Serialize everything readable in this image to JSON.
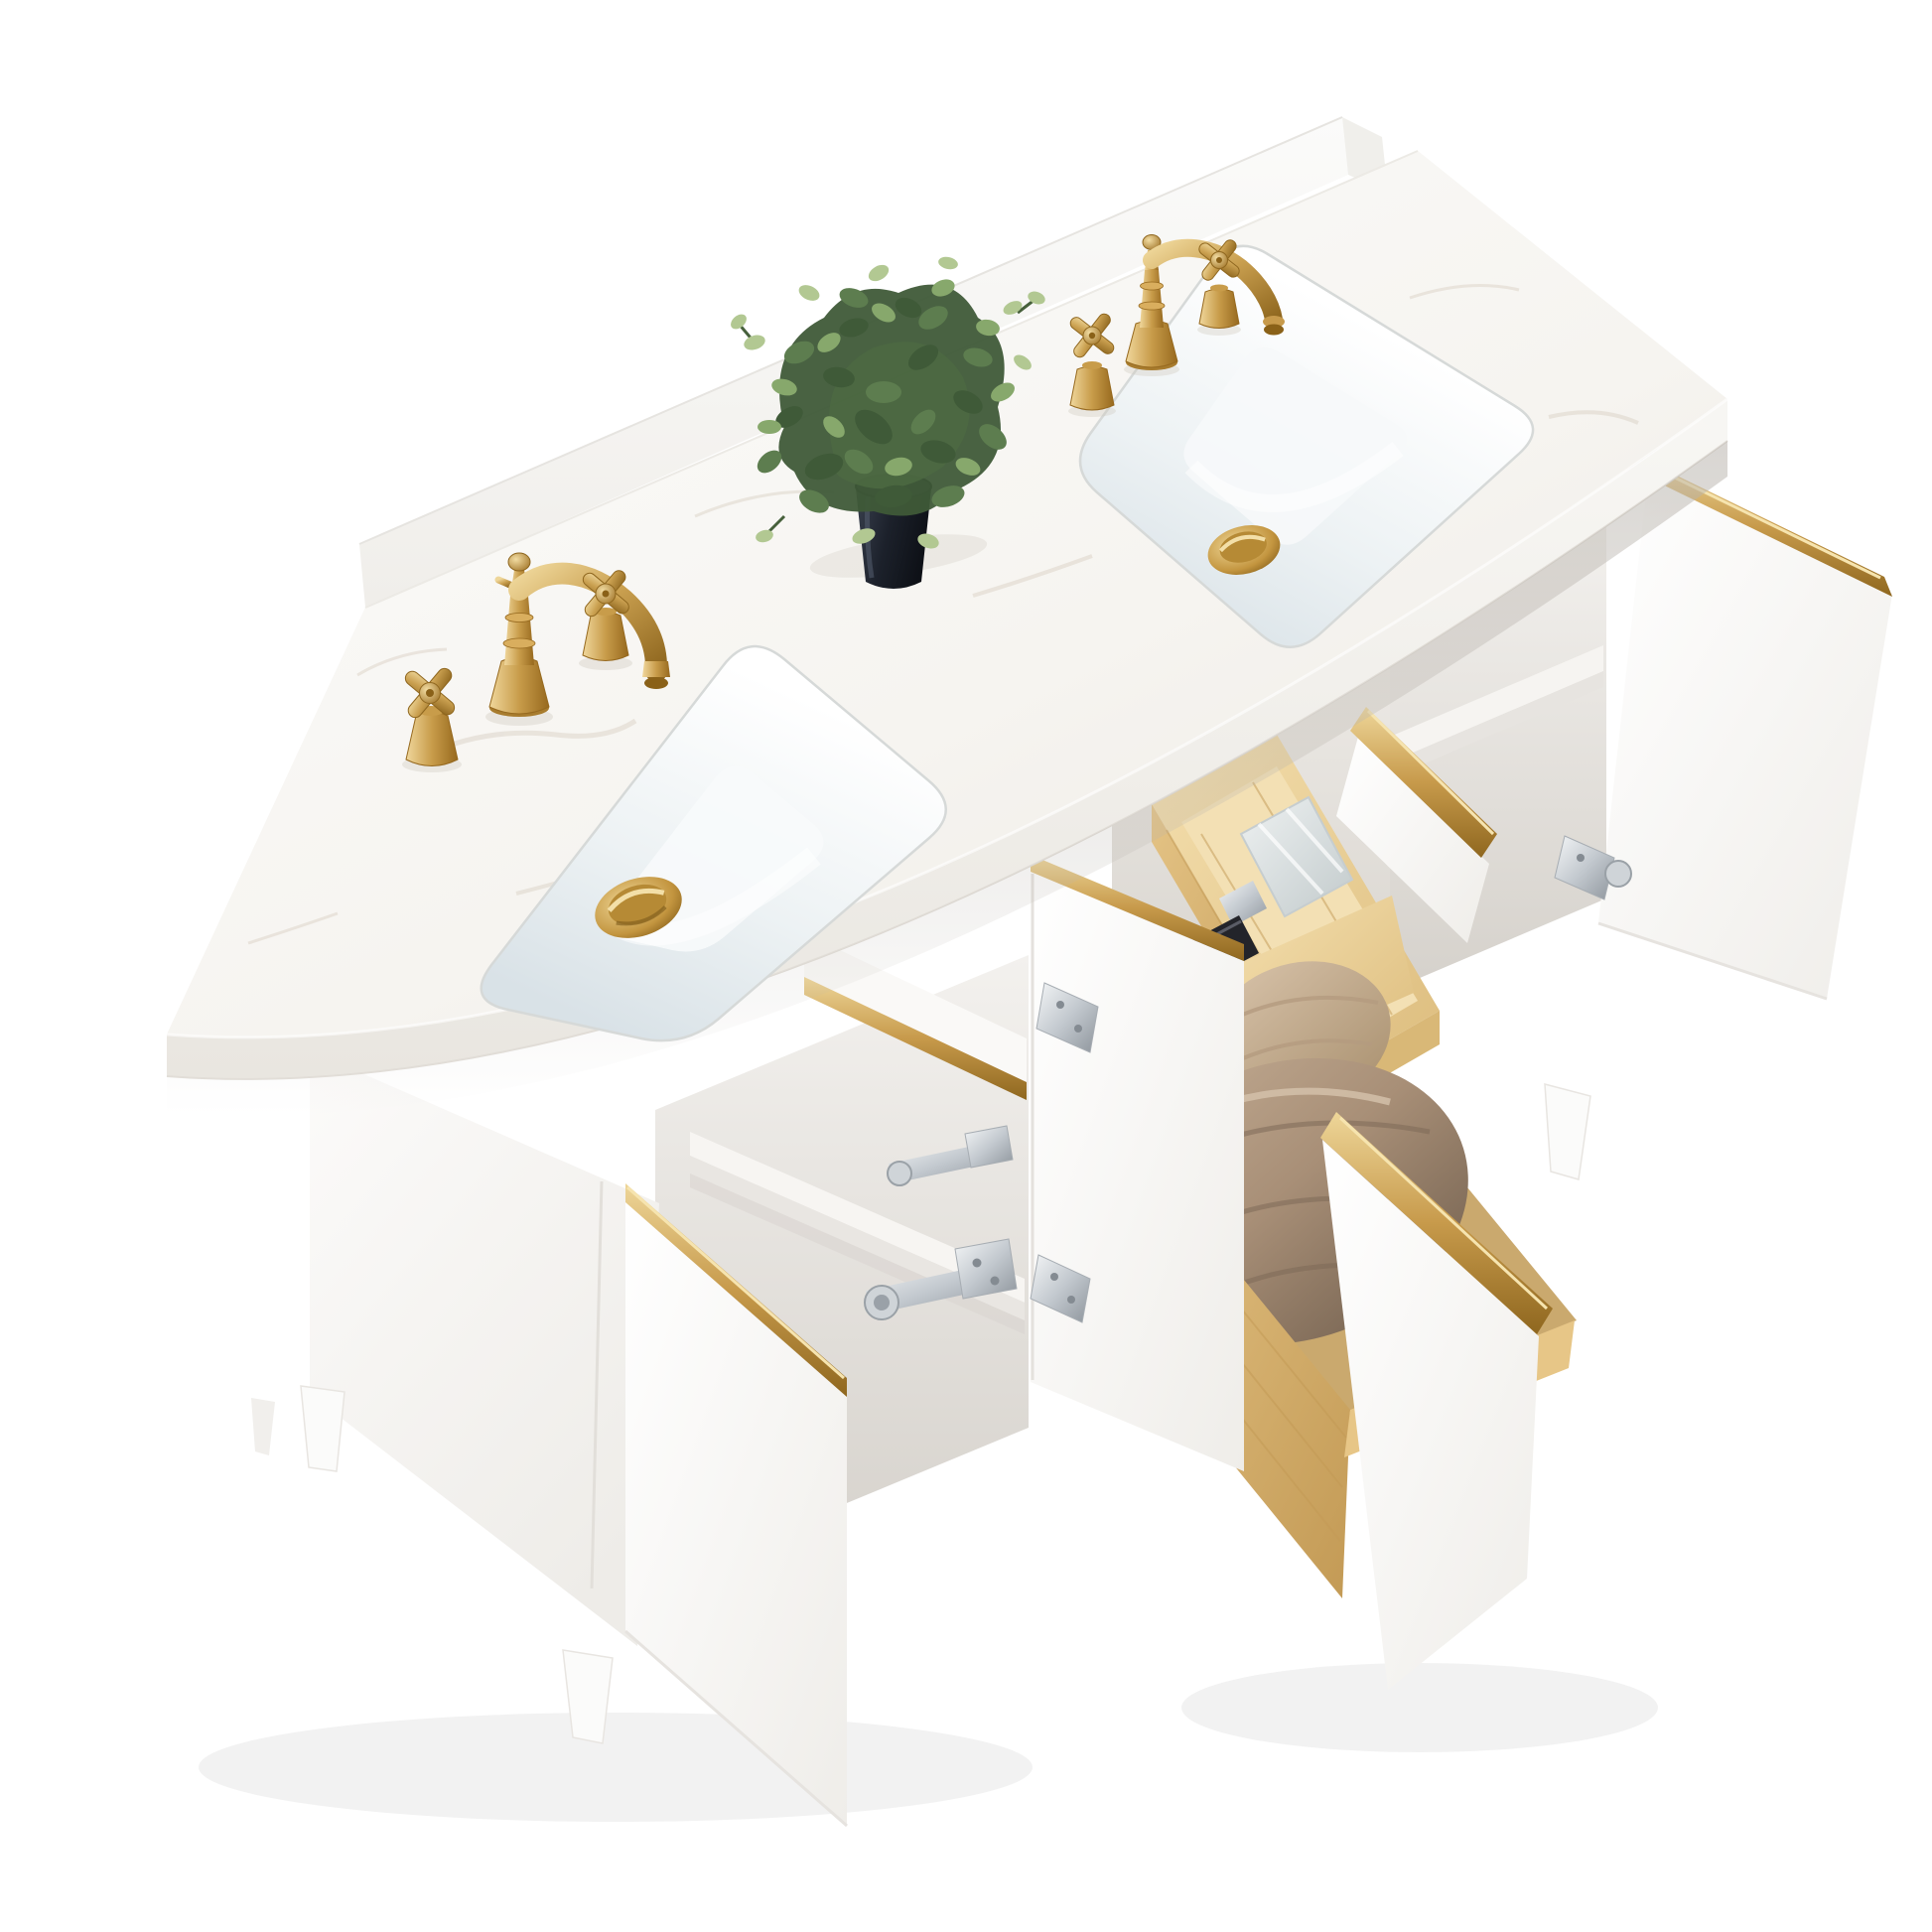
{
  "scene": {
    "type": "product-photo",
    "subject": "white double-sink bathroom vanity with brushed gold hardware, three-quarter overhead view",
    "background_color": "#ffffff",
    "parts": {
      "countertop": "white marble countertop with rear backsplash",
      "sinks": "2 undermount rectangular ceramic sinks",
      "faucets": "2 brushed-gold widespread faucets, cross handles",
      "drains": "2 brushed-gold pop-up drain caps",
      "plant": "small faux green plant in a dark navy pot",
      "doors": "3 open white doors with brushed-gold edge trim and brushed-nickel hinges",
      "drawers": "3 extended pine drawers with brushed-gold trim rails",
      "drawer_contents": [
        "pine organizer tray",
        "clear perfume bottle",
        "black cosmetic item",
        "beige folded towel",
        "taupe folded towel"
      ],
      "legs": "tapered white legs"
    }
  },
  "colors": {
    "marble_light": "#fdfdfc",
    "marble_mid": "#f6f4f0",
    "marble_dark": "#ece9e3",
    "vein": "#d8cec2",
    "face_light": "#f8f7f4",
    "face_dark": "#e9e6e0",
    "cabinet_light": "#fcfbfa",
    "cabinet_dark": "#eeece8",
    "cavity_light": "#f3f1ee",
    "cavity_dark": "#d5d1cb",
    "bay_dark": "#cfcbc4",
    "door_light": "#ffffff",
    "door_dark": "#efede9",
    "gold_light": "#eed699",
    "gold_mid": "#c79a4b",
    "gold_dark": "#8f671f",
    "chrome_light": "#f4f6f7",
    "chrome_mid": "#c3c9cf",
    "chrome_dark": "#8e959c",
    "pine_light": "#f4dfae",
    "pine_mid": "#ddbd7e",
    "pine_dark": "#c39a55",
    "towel_taupe_light": "#c3ac93",
    "towel_taupe_dark": "#7f6b58",
    "towel_beige_light": "#d8c3aa",
    "towel_beige_dark": "#b09878",
    "pot_light": "#3a414f",
    "pot_dark": "#0e1117",
    "leaf_dark": "#3f5a38",
    "leaf_mid": "#5d7d4f",
    "leaf_light": "#87a86c",
    "leaf_pale": "#b2c892",
    "basin_light": "#ffffff",
    "basin_shade": "#d9e2e7",
    "glass_light": "#eef1f1",
    "glass_dark": "#c2cacb",
    "shadow": "#b9b4ad"
  }
}
